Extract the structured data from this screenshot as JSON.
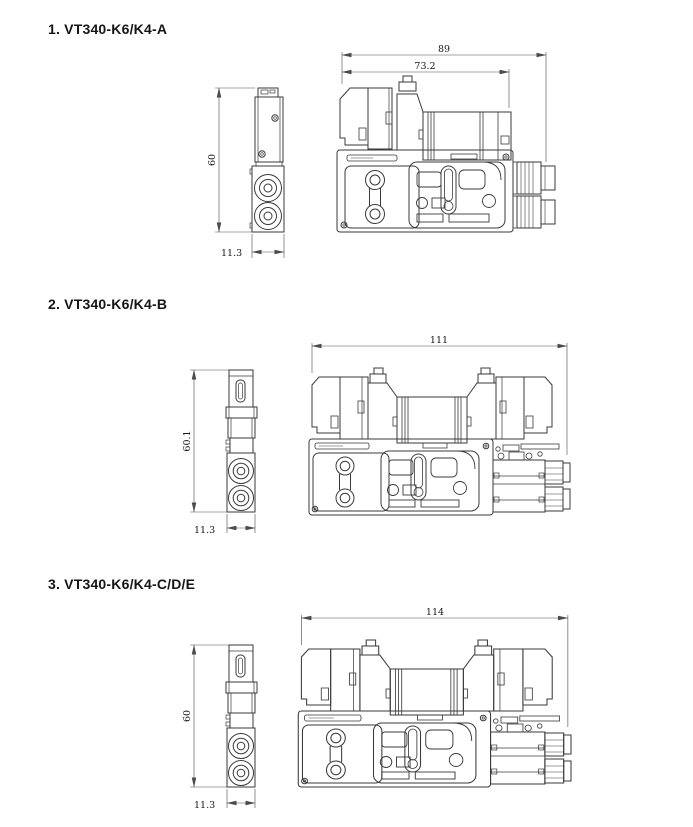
{
  "page": {
    "background_color": "#ffffff",
    "line_color": "#3a3a3a",
    "dimension_line_color": "#4a4a4a",
    "text_color": "#151515"
  },
  "sections": [
    {
      "title": "1. VT340-K6/K4-A",
      "side": {
        "dim_height": "60",
        "dim_width": "11.3"
      },
      "front": {
        "dim_overall_width": "89",
        "dim_body_width": "73.2"
      }
    },
    {
      "title": "2. VT340-K6/K4-B",
      "side": {
        "dim_height": "60.1",
        "dim_width": "11.3"
      },
      "front": {
        "dim_overall_width": "111"
      }
    },
    {
      "title": "3. VT340-K6/K4-C/D/E",
      "side": {
        "dim_height": "60",
        "dim_width": "11.3"
      },
      "front": {
        "dim_overall_width": "114"
      }
    }
  ]
}
